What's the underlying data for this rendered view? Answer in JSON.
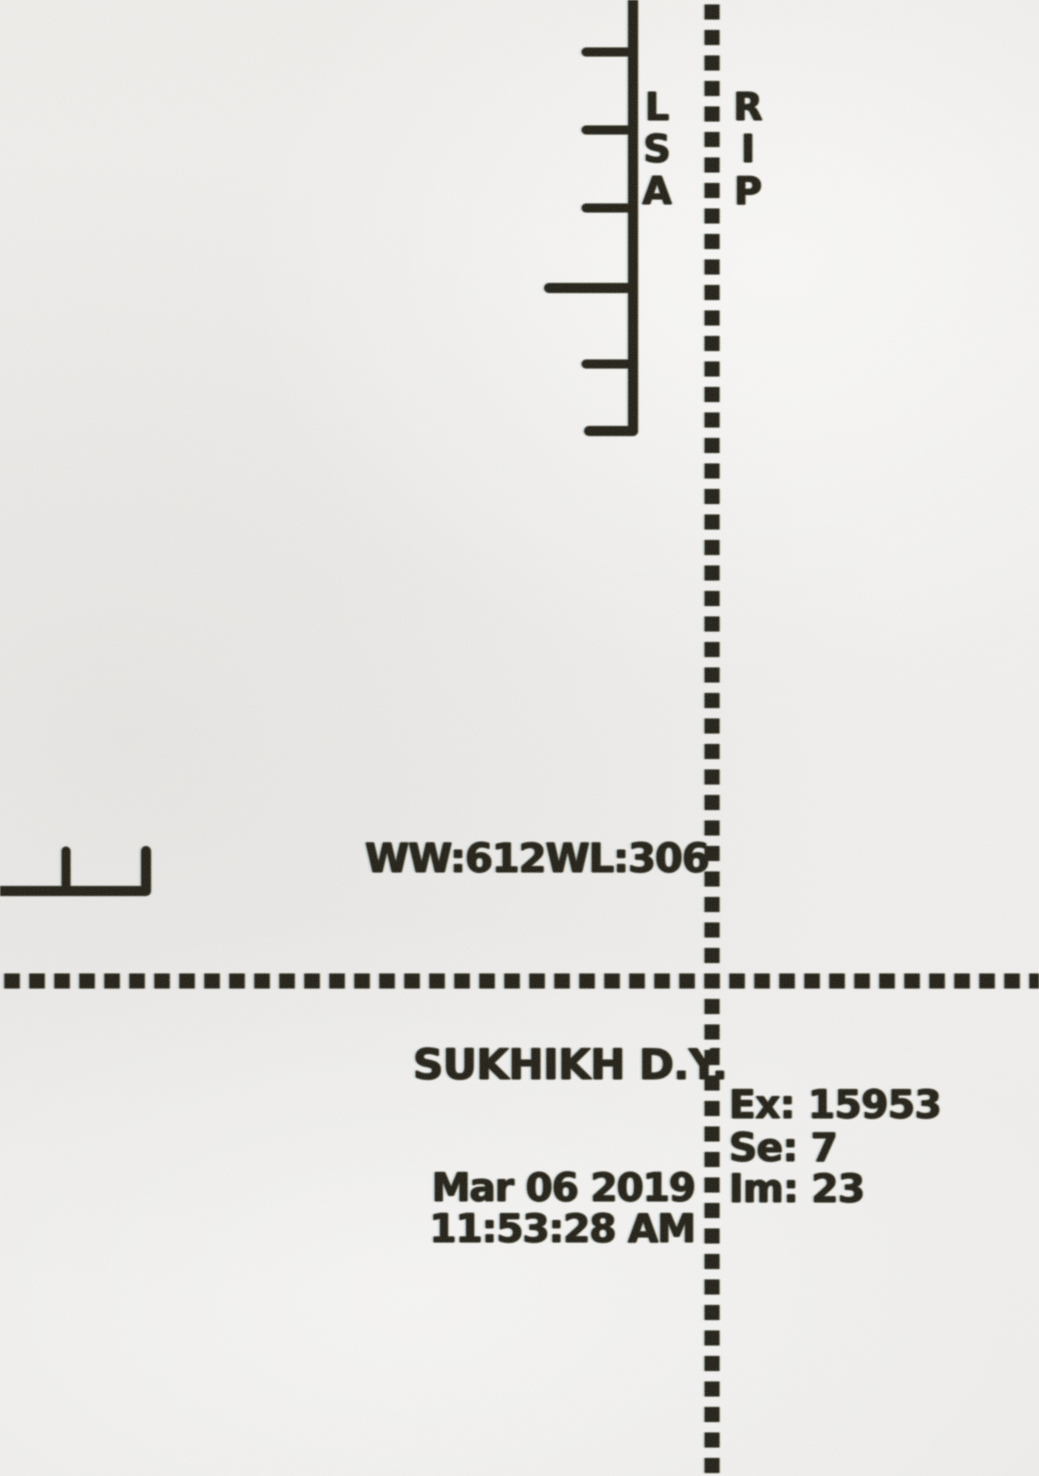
{
  "view": {
    "background_color": "#edecea",
    "ink_color": "#1b1912"
  },
  "orientation_markers": {
    "scale_side": [
      "L",
      "S",
      "A"
    ],
    "crosshair_side": [
      "R",
      "I",
      "P"
    ]
  },
  "annotations": {
    "window_settings": "WW:612WL:306",
    "patient_name": "SUKHIKH D.Y.",
    "exam": "Ex: 15953",
    "series": "Se: 7",
    "image": "Im: 23",
    "date": "Mar 06 2019",
    "time": "11:53:28 AM"
  }
}
